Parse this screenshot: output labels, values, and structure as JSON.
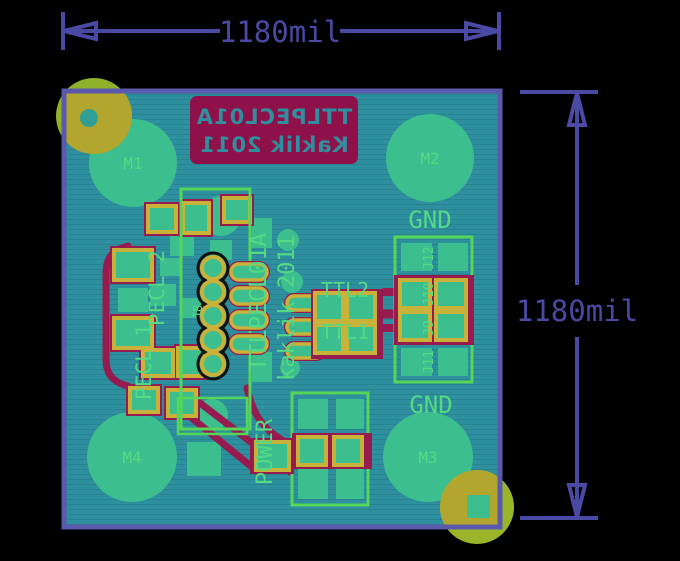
{
  "view": {
    "type": "pcb-board-layout-render",
    "background_color": "#000000"
  },
  "dimensions": {
    "horizontal": {
      "label": "1180mil"
    },
    "vertical": {
      "label": "1180mil"
    },
    "color": "#4A4AA5"
  },
  "board": {
    "outline_color": "#5B59AD",
    "substrate_color": "#2E8F9E",
    "copper_color": "#3CBE8F",
    "silk_color": "#55D983",
    "pad_ring_color": "#C9B23A",
    "trace_color": "#971B4F",
    "silk_block_color": "#8E1149",
    "drill_olive_color": "#B3A62E",
    "drill_chartreuse_color": "#8FB22B"
  },
  "silkscreen_bottom": {
    "line1": "TTLPECL01A",
    "line2": "Kaklik 2011"
  },
  "silkscreen_top": {
    "part_title": "TTLPECL01A",
    "author": "kaklik 2011",
    "power_label": "POWER",
    "gnd_top": "GND",
    "gnd_bottom": "GND",
    "ttl2": "TTL2",
    "ttl1": "TTL1",
    "pecl1": "PECL 1",
    "pecl2": "PECL 2",
    "j8": "J8",
    "j9": "J9",
    "j10": "J10",
    "j11": "J11",
    "j12": "J12"
  },
  "mounting_holes": {
    "m1": "M1",
    "m2": "M2",
    "m3": "M3",
    "m4": "M4"
  }
}
